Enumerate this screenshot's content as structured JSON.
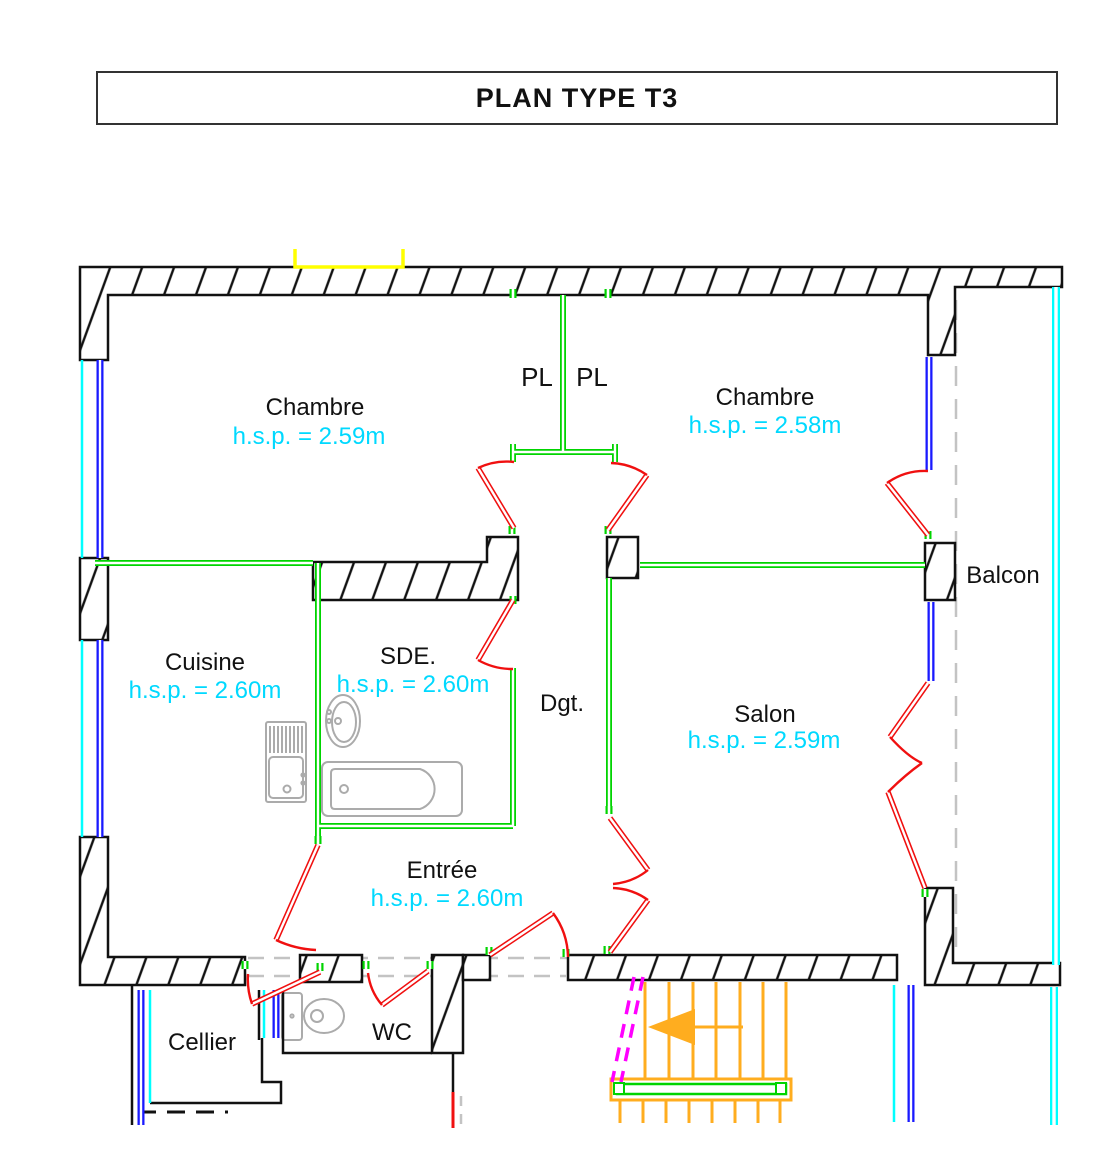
{
  "title": "PLAN TYPE T3",
  "labels": {
    "chambre1": {
      "name": "Chambre",
      "hsp": "h.s.p. = 2.59m"
    },
    "chambre2": {
      "name": "Chambre",
      "hsp": "h.s.p. = 2.58m"
    },
    "cuisine": {
      "name": "Cuisine",
      "hsp": "h.s.p. = 2.60m"
    },
    "sde": {
      "name": "SDE.",
      "hsp": "h.s.p. = 2.60m"
    },
    "salon": {
      "name": "Salon",
      "hsp": "h.s.p. = 2.59m"
    },
    "entree": {
      "name": "Entrée",
      "hsp": "h.s.p. = 2.60m"
    },
    "dgt": {
      "name": "Dgt."
    },
    "balcon": {
      "name": "Balcon"
    },
    "cellier": {
      "name": "Cellier"
    },
    "wc": {
      "name": "WC"
    },
    "pl_left": {
      "name": "PL"
    },
    "pl_right": {
      "name": "PL"
    }
  },
  "palette": {
    "wall": "#111111",
    "text": "#111111",
    "green": "#00d400",
    "red": "#f01010",
    "blue": "#1a1aff",
    "cyan": "#00ffff",
    "cyantext": "#00d9ff",
    "orange": "#ffad1f",
    "magenta": "#ff00ff",
    "yellow": "#ffff00",
    "graydash": "#c3c3c3",
    "fixture": "#ababab"
  }
}
